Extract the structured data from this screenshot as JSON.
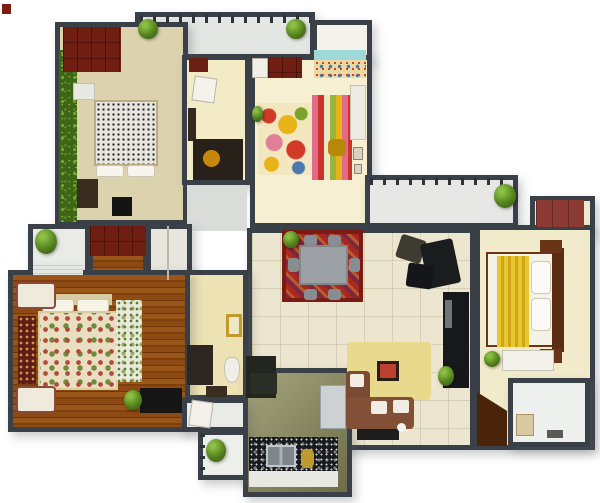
{
  "meta": {
    "kind": "3d-rendered-floor-plan",
    "canvas": {
      "width": 600,
      "height": 503,
      "background": "#ffffff"
    }
  },
  "palette": {
    "wall": "#3a4047",
    "floor_cream": "#f2ebcb",
    "floor_tile": "#ece5cf",
    "wood_brown": "#8d4a12",
    "wardrobe_red": "#701d12",
    "rug_red": "#a8291f",
    "sofa_brown": "#7e4c34",
    "bed_throw_yellow": "#e7c832",
    "granite_black": "#191b1d",
    "hedge_green": "#4c7a1d",
    "balcony_gray": "#e4e6e3"
  },
  "scene": {
    "rooms": [
      {
        "name": "top-balcony",
        "x": 135,
        "y": 12,
        "w": 180,
        "h": 47,
        "floor": "#e4e6e3"
      },
      {
        "name": "kids-room-alcove",
        "x": 312,
        "y": 20,
        "w": 60,
        "h": 42,
        "floor": "#f4f2ea"
      },
      {
        "name": "bedroom-top-left",
        "x": 55,
        "y": 22,
        "w": 133,
        "h": 203,
        "floor": "#ddd2ae"
      },
      {
        "name": "dressing-room",
        "x": 182,
        "y": 55,
        "w": 68,
        "h": 130,
        "floor": "#f2ebc6"
      },
      {
        "name": "kids-room",
        "x": 250,
        "y": 55,
        "w": 122,
        "h": 173,
        "floor": "#f6efd2"
      },
      {
        "name": "hallway-corridor",
        "x": 187,
        "y": 185,
        "w": 60,
        "h": 46,
        "floor": "#d9dcd8",
        "nowall": true
      },
      {
        "name": "right-balcony",
        "x": 365,
        "y": 175,
        "w": 153,
        "h": 53,
        "floor": "#e7e8e5"
      },
      {
        "name": "bedroom-right-wardrobe-notch",
        "x": 530,
        "y": 196,
        "w": 65,
        "h": 38,
        "floor": "#efe9d2"
      },
      {
        "name": "living-dining-room",
        "x": 247,
        "y": 228,
        "w": 228,
        "h": 222,
        "pattern": "tile"
      },
      {
        "name": "bedroom-right",
        "x": 475,
        "y": 225,
        "w": 120,
        "h": 225,
        "floor": "#f2ebcb"
      },
      {
        "name": "left-balcony",
        "x": 28,
        "y": 224,
        "w": 62,
        "h": 58,
        "floor": "#e9ebe7"
      },
      {
        "name": "master-wardrobe-nook",
        "x": 88,
        "y": 224,
        "w": 60,
        "h": 58,
        "pattern": "wood"
      },
      {
        "name": "closet-nook",
        "x": 146,
        "y": 224,
        "w": 46,
        "h": 58,
        "floor": "#e7e5dc"
      },
      {
        "name": "master-bathroom",
        "x": 182,
        "y": 270,
        "w": 66,
        "h": 130,
        "floor": "#ece2b4"
      },
      {
        "name": "master-bedroom",
        "x": 8,
        "y": 270,
        "w": 182,
        "h": 162,
        "pattern": "wood"
      },
      {
        "name": "kitchen",
        "x": 243,
        "y": 368,
        "w": 109,
        "h": 129,
        "pattern": "kitchenfloor"
      },
      {
        "name": "bathroom-lobby",
        "x": 182,
        "y": 398,
        "w": 66,
        "h": 34,
        "floor": "#e9ebe6"
      },
      {
        "name": "utility-balcony",
        "x": 198,
        "y": 430,
        "w": 50,
        "h": 50,
        "floor": "#edefeb"
      },
      {
        "name": "ensuite-bathroom",
        "x": 508,
        "y": 378,
        "w": 82,
        "h": 69,
        "floor": "#eef0ed"
      }
    ],
    "items": [
      {
        "name": "corner-mark",
        "x": 2,
        "y": 4,
        "w": 9,
        "h": 10,
        "color": "#7c1d12"
      },
      {
        "name": "balcony-railing",
        "x": 140,
        "y": 15,
        "w": 170,
        "h": 8,
        "pattern": "railing"
      },
      {
        "name": "hedge-strip",
        "x": 59,
        "y": 50,
        "w": 18,
        "h": 172,
        "pattern": "hedge"
      },
      {
        "name": "wardrobe-top-left",
        "x": 63,
        "y": 27,
        "w": 58,
        "h": 45,
        "pattern": "wardrobe"
      },
      {
        "name": "white-desk",
        "x": 73,
        "y": 83,
        "w": 22,
        "h": 17,
        "color": "#e9e9e3",
        "border": "1px solid #c2c0b4"
      },
      {
        "name": "bed-speckled-duvet",
        "x": 94,
        "y": 100,
        "w": 64,
        "h": 66,
        "pattern": "speckle-bw"
      },
      {
        "name": "bed-pillow",
        "x": 96,
        "y": 165,
        "w": 28,
        "h": 12,
        "color": "#f7f5ee",
        "border": "1px solid #ccc6b5",
        "radius": "3px"
      },
      {
        "name": "bed-pillow",
        "x": 127,
        "y": 165,
        "w": 28,
        "h": 12,
        "color": "#f7f5ee",
        "border": "1px solid #ccc6b5",
        "radius": "3px"
      },
      {
        "name": "dresser",
        "x": 77,
        "y": 179,
        "w": 21,
        "h": 29,
        "color": "#3a2c1f"
      },
      {
        "name": "tv-floor-unit",
        "x": 112,
        "y": 197,
        "w": 20,
        "h": 19,
        "color": "#141414"
      },
      {
        "name": "red-shelf",
        "x": 189,
        "y": 58,
        "w": 19,
        "h": 14,
        "color": "#6b2014"
      },
      {
        "name": "door-leaf",
        "x": 193,
        "y": 77,
        "w": 23,
        "h": 25,
        "color": "#f4f2ea",
        "border": "1px solid #b8b4a6",
        "rotate": 8
      },
      {
        "name": "dark-shelf",
        "x": 188,
        "y": 108,
        "w": 8,
        "h": 33,
        "color": "#35291e"
      },
      {
        "name": "study-desk",
        "x": 193,
        "y": 139,
        "w": 50,
        "h": 41,
        "color": "#28211a"
      },
      {
        "name": "gold-stool",
        "x": 203,
        "y": 150,
        "w": 17,
        "h": 17,
        "color": "#c8870c",
        "radius": "50%"
      },
      {
        "name": "door-leaf",
        "x": 252,
        "y": 58,
        "w": 16,
        "h": 20,
        "color": "#f2efe6",
        "border": "1px solid #b8b4a6"
      },
      {
        "name": "kids-wardrobe",
        "x": 268,
        "y": 57,
        "w": 34,
        "h": 21,
        "pattern": "wardrobe"
      },
      {
        "name": "mural-sky",
        "x": 314,
        "y": 50,
        "w": 52,
        "h": 10,
        "color": "#9fd8d8"
      },
      {
        "name": "mural-sand",
        "x": 314,
        "y": 60,
        "w": 52,
        "h": 18,
        "pattern": "mural"
      },
      {
        "name": "kids-rug-circles",
        "x": 258,
        "y": 103,
        "w": 54,
        "h": 72,
        "pattern": "rug-kids"
      },
      {
        "name": "kids-play-unit",
        "x": 312,
        "y": 95,
        "w": 40,
        "h": 85,
        "pattern": "stripes"
      },
      {
        "name": "toy-basket",
        "x": 328,
        "y": 139,
        "w": 18,
        "h": 17,
        "color": "#b8860b",
        "radius": "30%"
      },
      {
        "name": "kids-closet",
        "x": 350,
        "y": 85,
        "w": 16,
        "h": 55,
        "color": "#eceae2",
        "border": "1px solid #c5c2b5"
      },
      {
        "name": "wall-frame",
        "x": 353,
        "y": 147,
        "w": 10,
        "h": 13,
        "color": "#d9d2c2",
        "border": "1px solid #8a8474"
      },
      {
        "name": "wall-frame",
        "x": 354,
        "y": 164,
        "w": 8,
        "h": 10,
        "color": "#d9d2c2",
        "border": "1px solid #8a8474"
      },
      {
        "name": "balcony-railing",
        "x": 370,
        "y": 178,
        "w": 142,
        "h": 7,
        "pattern": "railing"
      },
      {
        "name": "wardrobe-right-red",
        "x": 536,
        "y": 200,
        "w": 48,
        "h": 27,
        "pattern": "wardrobe-brick"
      },
      {
        "name": "bed-mattress",
        "x": 486,
        "y": 252,
        "w": 70,
        "h": 95,
        "color": "#f4f1e5",
        "border": "2px solid #6a3416"
      },
      {
        "name": "bed-yellow-throw",
        "x": 497,
        "y": 256,
        "w": 32,
        "h": 91,
        "pattern": "throw"
      },
      {
        "name": "bed-pillow",
        "x": 531,
        "y": 261,
        "w": 20,
        "h": 33,
        "color": "#fbfaf6",
        "border": "1px solid #cfc9b8",
        "radius": "4px"
      },
      {
        "name": "bed-pillow",
        "x": 531,
        "y": 298,
        "w": 20,
        "h": 33,
        "color": "#fbfaf6",
        "border": "1px solid #cfc9b8",
        "radius": "4px"
      },
      {
        "name": "bed-headboard",
        "x": 552,
        "y": 248,
        "w": 12,
        "h": 104,
        "color": "#5a2c12"
      },
      {
        "name": "nightstand",
        "x": 540,
        "y": 240,
        "w": 22,
        "h": 13,
        "color": "#6a3416"
      },
      {
        "name": "nightstand",
        "x": 540,
        "y": 349,
        "w": 22,
        "h": 14,
        "color": "#6a3416"
      },
      {
        "name": "bedroom-bench",
        "x": 502,
        "y": 350,
        "w": 52,
        "h": 21,
        "color": "#f2f1ea",
        "border": "1px solid #c9c5b6"
      },
      {
        "name": "brown-floor-mat",
        "x": 477,
        "y": 392,
        "w": 30,
        "h": 54,
        "color": "#4a2408",
        "clip": "polygon(0 0, 100% 35%, 100% 100%, 0 100%)"
      },
      {
        "name": "vanity-box",
        "x": 516,
        "y": 414,
        "w": 18,
        "h": 22,
        "color": "#d9c9a0",
        "border": "1px solid #a89468"
      },
      {
        "name": "bath-accessories",
        "x": 547,
        "y": 430,
        "w": 16,
        "h": 8,
        "color": "#5a5a55"
      },
      {
        "name": "dining-rug",
        "x": 282,
        "y": 230,
        "w": 81,
        "h": 72,
        "pattern": "rug-oriental"
      },
      {
        "name": "dining-table",
        "x": 299,
        "y": 245,
        "w": 49,
        "h": 40,
        "color": "#9ba1a5",
        "border": "2px solid #80868a"
      },
      {
        "name": "dining-chair",
        "x": 304,
        "y": 235,
        "w": 13,
        "h": 11,
        "color": "#878d91",
        "radius": "3px"
      },
      {
        "name": "dining-chair",
        "x": 328,
        "y": 235,
        "w": 13,
        "h": 11,
        "color": "#878d91",
        "radius": "3px"
      },
      {
        "name": "dining-chair",
        "x": 304,
        "y": 289,
        "w": 13,
        "h": 11,
        "color": "#878d91",
        "radius": "3px"
      },
      {
        "name": "dining-chair",
        "x": 328,
        "y": 289,
        "w": 13,
        "h": 11,
        "color": "#878d91",
        "radius": "3px"
      },
      {
        "name": "dining-chair",
        "x": 288,
        "y": 258,
        "w": 11,
        "h": 14,
        "color": "#878d91",
        "radius": "3px"
      },
      {
        "name": "dining-chair",
        "x": 349,
        "y": 258,
        "w": 11,
        "h": 14,
        "color": "#878d91",
        "radius": "3px"
      },
      {
        "name": "lounge-chair",
        "x": 398,
        "y": 237,
        "w": 26,
        "h": 24,
        "color": "#3e3c30",
        "rotate": 18,
        "radius": "3px"
      },
      {
        "name": "lounge-chair",
        "x": 424,
        "y": 241,
        "w": 33,
        "h": 45,
        "color": "#1a1c1e",
        "rotate": -12,
        "radius": "3px"
      },
      {
        "name": "ottoman",
        "x": 407,
        "y": 264,
        "w": 26,
        "h": 24,
        "color": "#141619",
        "rotate": 8,
        "radius": "3px"
      },
      {
        "name": "tv-cabinet",
        "x": 443,
        "y": 292,
        "w": 26,
        "h": 96,
        "color": "#17181b"
      },
      {
        "name": "tv-cabinet-shelf",
        "x": 445,
        "y": 300,
        "w": 7,
        "h": 28,
        "color": "#70747a"
      },
      {
        "name": "family-rug",
        "x": 347,
        "y": 342,
        "w": 84,
        "h": 58,
        "color": "#e9d98c",
        "radius": "4px"
      },
      {
        "name": "picture-frame",
        "x": 377,
        "y": 361,
        "w": 22,
        "h": 20,
        "color": "#c04030",
        "border": "3px solid #2b1d13"
      },
      {
        "name": "sofa-arm-section",
        "x": 346,
        "y": 371,
        "w": 24,
        "h": 57,
        "color": "#7a4a33",
        "radius": "4px"
      },
      {
        "name": "sofa-seat-section",
        "x": 346,
        "y": 397,
        "w": 68,
        "h": 32,
        "color": "#815036",
        "radius": "4px"
      },
      {
        "name": "sofa-cushion",
        "x": 350,
        "y": 374,
        "w": 14,
        "h": 13,
        "color": "#f1ede2",
        "radius": "2px"
      },
      {
        "name": "sofa-cushion",
        "x": 371,
        "y": 401,
        "w": 16,
        "h": 13,
        "color": "#f1ede2",
        "radius": "2px"
      },
      {
        "name": "sofa-cushion",
        "x": 393,
        "y": 400,
        "w": 16,
        "h": 13,
        "color": "#f1ede2",
        "radius": "2px"
      },
      {
        "name": "coffee-table",
        "x": 357,
        "y": 429,
        "w": 42,
        "h": 11,
        "color": "#1d1d1d"
      },
      {
        "name": "pet-figure",
        "x": 397,
        "y": 423,
        "w": 9,
        "h": 9,
        "color": "#f4f4ef",
        "radius": "50%"
      },
      {
        "name": "tall-cabinet",
        "x": 246,
        "y": 356,
        "w": 30,
        "h": 42,
        "color": "#23261f"
      },
      {
        "name": "kitchen-cabinet",
        "x": 250,
        "y": 373,
        "w": 27,
        "h": 21,
        "color": "#2b2e27"
      },
      {
        "name": "fridge",
        "x": 320,
        "y": 385,
        "w": 26,
        "h": 44,
        "color": "#ccd1d3",
        "border": "1px solid #9aa0a4"
      },
      {
        "name": "granite-counter",
        "x": 249,
        "y": 437,
        "w": 89,
        "h": 34,
        "pattern": "granite"
      },
      {
        "name": "kitchen-sink",
        "x": 266,
        "y": 445,
        "w": 30,
        "h": 22,
        "pattern": "sink"
      },
      {
        "name": "gold-basket",
        "x": 301,
        "y": 449,
        "w": 13,
        "h": 19,
        "color": "#bf9a30",
        "radius": "30%"
      },
      {
        "name": "counter-toe-strip",
        "x": 249,
        "y": 471,
        "w": 89,
        "h": 16,
        "color": "#e9e9e4"
      },
      {
        "name": "bath-vanity",
        "x": 187,
        "y": 345,
        "w": 26,
        "h": 40,
        "color": "#2e2620"
      },
      {
        "name": "toilet",
        "x": 224,
        "y": 357,
        "w": 16,
        "h": 26,
        "color": "#f0efe7",
        "border": "1px solid #c5c2b5",
        "radius": "40% 40% 50% 50%"
      },
      {
        "name": "gold-mirror",
        "x": 226,
        "y": 314,
        "w": 16,
        "h": 23,
        "color": "#efe8c8",
        "border": "3px solid #c49a2a"
      },
      {
        "name": "bath-mat",
        "x": 206,
        "y": 386,
        "w": 21,
        "h": 11,
        "color": "#3a2c1e"
      },
      {
        "name": "door-leaf",
        "x": 190,
        "y": 401,
        "w": 22,
        "h": 26,
        "color": "#f3f1e9",
        "border": "1px solid #b8b4a6",
        "rotate": 8
      },
      {
        "name": "utility-railing",
        "x": 200,
        "y": 434,
        "w": 5,
        "h": 44,
        "pattern": "railing-v"
      },
      {
        "name": "balcony-shelf",
        "x": 33,
        "y": 262,
        "w": 50,
        "h": 13,
        "pattern": "lines"
      },
      {
        "name": "master-wardrobe-red",
        "x": 90,
        "y": 226,
        "w": 56,
        "h": 30,
        "pattern": "wardrobe"
      },
      {
        "name": "closet-door-line",
        "x": 167,
        "y": 226,
        "w": 2,
        "h": 54,
        "color": "#b9b7ae"
      },
      {
        "name": "bedside-runner-rug",
        "x": 18,
        "y": 316,
        "w": 18,
        "h": 68,
        "pattern": "runner"
      },
      {
        "name": "bed-headboard",
        "x": 38,
        "y": 294,
        "w": 74,
        "h": 11,
        "color": "#d9cba0"
      },
      {
        "name": "bed-pillow",
        "x": 42,
        "y": 299,
        "w": 32,
        "h": 13,
        "color": "#f6f3e7",
        "border": "1px solid #ccc6b5",
        "radius": "3px"
      },
      {
        "name": "bed-pillow",
        "x": 77,
        "y": 299,
        "w": 32,
        "h": 13,
        "color": "#f6f3e7",
        "border": "1px solid #ccc6b5",
        "radius": "3px"
      },
      {
        "name": "bed-floral-quilt",
        "x": 38,
        "y": 311,
        "w": 80,
        "h": 79,
        "pattern": "quilt"
      },
      {
        "name": "bed-textured-throw",
        "x": 116,
        "y": 300,
        "w": 26,
        "h": 82,
        "pattern": "speckle-gw"
      },
      {
        "name": "armchair",
        "x": 16,
        "y": 282,
        "w": 40,
        "h": 27,
        "color": "#efeadb",
        "border": "2px solid #8a4a3a",
        "radius": "4px"
      },
      {
        "name": "armchair",
        "x": 16,
        "y": 386,
        "w": 40,
        "h": 27,
        "color": "#efeadb",
        "border": "2px solid #8a4a3a",
        "radius": "4px"
      },
      {
        "name": "tv-console",
        "x": 140,
        "y": 388,
        "w": 42,
        "h": 25,
        "color": "#161616"
      }
    ],
    "plants": [
      {
        "name": "plant-balcony-left",
        "x": 138,
        "y": 19,
        "w": 20,
        "h": 20
      },
      {
        "name": "plant-balcony-right",
        "x": 286,
        "y": 19,
        "w": 20,
        "h": 20
      },
      {
        "name": "plant-kids-room",
        "x": 252,
        "y": 106,
        "w": 11,
        "h": 16
      },
      {
        "name": "plant-dining-rug",
        "x": 283,
        "y": 231,
        "w": 16,
        "h": 17
      },
      {
        "name": "plant-right-balcony",
        "x": 494,
        "y": 184,
        "w": 22,
        "h": 24
      },
      {
        "name": "plant-left-balcony",
        "x": 35,
        "y": 229,
        "w": 22,
        "h": 25
      },
      {
        "name": "plant-tv-wall",
        "x": 438,
        "y": 366,
        "w": 16,
        "h": 20
      },
      {
        "name": "plant-bedroom-right",
        "x": 484,
        "y": 351,
        "w": 16,
        "h": 16
      },
      {
        "name": "plant-master-bedroom",
        "x": 124,
        "y": 390,
        "w": 18,
        "h": 20
      },
      {
        "name": "plant-utility-balcony",
        "x": 206,
        "y": 439,
        "w": 20,
        "h": 23
      }
    ]
  }
}
